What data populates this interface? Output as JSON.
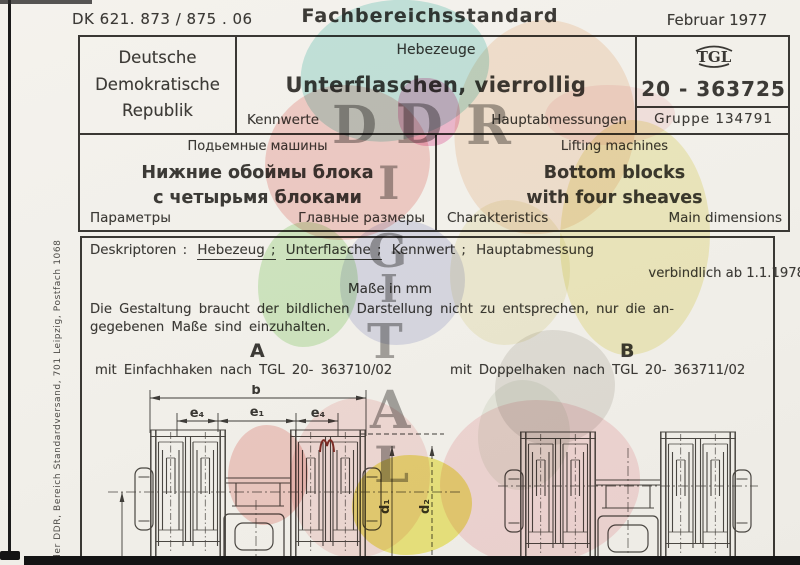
{
  "page": {
    "dk_number": "DK 621. 873 / 875 . 06",
    "doc_type": "Fachbereichsstandard",
    "date": "Februar 1977"
  },
  "header": {
    "country_line1": "Deutsche",
    "country_line2": "Demokratische",
    "country_line3": "Republik",
    "category": "Hebezeuge",
    "title": "Unterflaschen, vierrollig",
    "left_sub": "Kennwerte",
    "right_sub": "Hauptabmessungen",
    "tgl_logo": "TGL",
    "standard_number": "20 - 363725",
    "group_label": "Gruppe 134791"
  },
  "russian": {
    "category": "Подьемные машины",
    "title_line1": "Нижние обоймы блока",
    "title_line2": "с четырьмя блоками",
    "left_sub": "Параметры",
    "right_sub": "Главные размеры"
  },
  "english": {
    "category": "Lifting machines",
    "title_line1": "Bottom blocks",
    "title_line2": "with four sheaves",
    "left_sub": "Charakteristics",
    "right_sub": "Main dimensions"
  },
  "body": {
    "descriptors_label": "Deskriptoren :",
    "descriptor1": "Hebezeug ;",
    "descriptor2": "Unterflasche ;",
    "descriptor3": "Kennwert ;",
    "descriptor4": "Hauptabmessung",
    "valid_from": "verbindlich ab 1.1.1978",
    "units_note": "Maße in mm",
    "note_line1": "Die Gestaltung braucht der bildlichen Darstellung nicht zu entsprechen, nur die an-",
    "note_line2": "gegebenen Maße sind einzuhalten.",
    "variant_a_label": "A",
    "variant_a_caption": "mit Einfachhaken nach TGL 20- 363710/02",
    "variant_b_label": "B",
    "variant_b_caption": "mit Doppelhaken nach TGL 20- 363711/02"
  },
  "drawing": {
    "dims": {
      "b": "b",
      "e1": "e₁",
      "e4_left": "e₄",
      "e4_right": "e₄",
      "d1": "d₁",
      "d2": "d₂"
    }
  },
  "sidebar_text": "der DDR, Bereich Standardversand, 701 Leipzig, Postfach 1068",
  "watermark": {
    "letters": [
      "D",
      "D",
      "R",
      "I",
      "G",
      "I",
      "T",
      "A",
      "L"
    ]
  },
  "colors": {
    "ink": "#3c3a36",
    "paper": "#f2f0ea",
    "scan_edge": "#141414",
    "map_cyan": "#9fdcd6",
    "map_pink": "#f3b3ae",
    "map_green": "#b7e6a6",
    "map_lavender": "#c9cbe8",
    "map_yellow": "#efe9a0",
    "map_bright_yellow": "#ece437",
    "map_salmon": "#f6d8c0",
    "map_magenta": "#ee8fc0"
  }
}
